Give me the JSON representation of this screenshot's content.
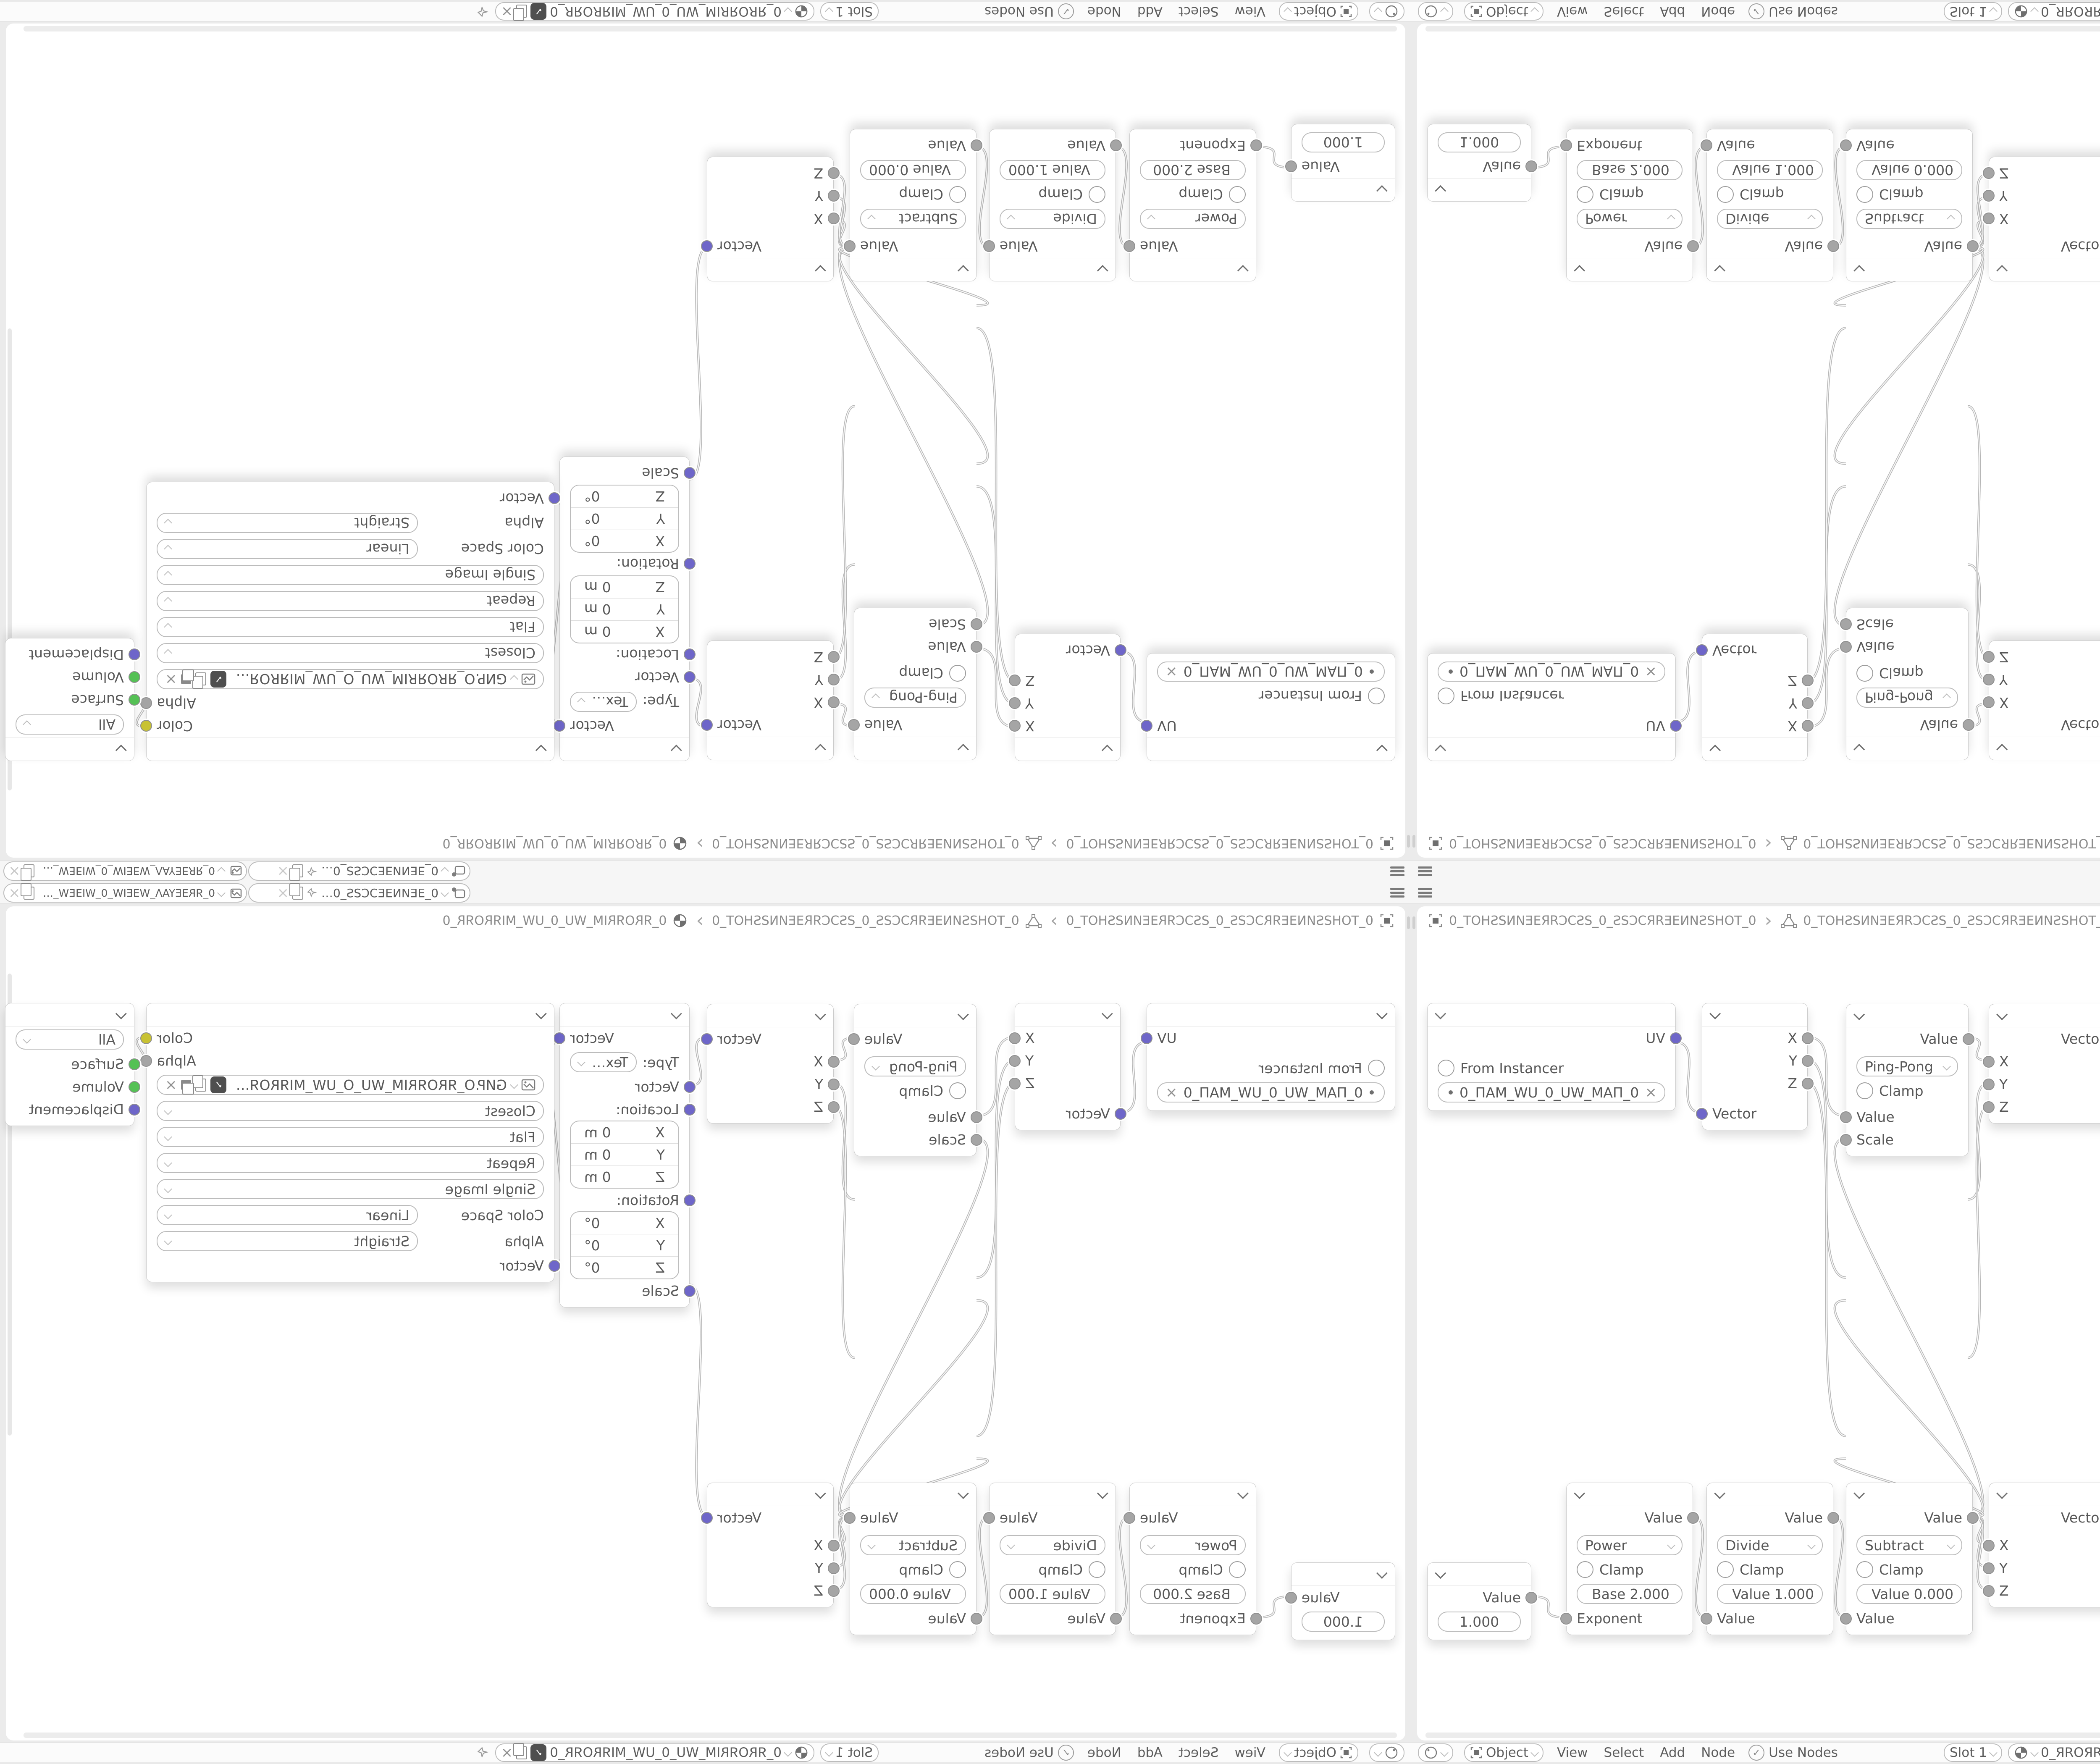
{
  "colors": {
    "socket_vector": "#6e66c9",
    "socket_value": "#a5a5a5",
    "socket_color": "#c8c233",
    "socket_shader": "#55c155",
    "wire": "#b6b6b6",
    "node_bg": "#ffffff",
    "editor_bg": "#ffffff",
    "chrome_bg": "#f6f6f6"
  },
  "topbar": {
    "scene_name": "0_ƎEИNƎEƆCƧS_0_ƧSƆCƎEИNƎE_0",
    "view_layer_name": "0_ЯRƎEYAΛ_WƎEIW_0_WIƎEW_ΛAYƎEЯR_0"
  },
  "breadcrumb": {
    "scene": "0_TOHƧSИNƎEЯRƆCƧS_0_ƧSƆCЯRƎEИNƧSHOT_0",
    "object": "0_TOHƧSИNƎEЯRƆCƧS_0_ƧSƆCЯRƎEИNƧSHOT_0",
    "material": "0_ЯROЯRIM_WU_0_UW_MIЯROЯR_0"
  },
  "statusbar": {
    "shader_type": "Object",
    "menus": [
      "View",
      "Select",
      "Add",
      "Node"
    ],
    "use_nodes": "Use Nodes",
    "slot": "Slot 1",
    "material_name": "0_ЯROЯRIM_WU_0_UW_MIЯROЯR_0"
  },
  "axes": [
    "X",
    "Y",
    "Z"
  ],
  "nodes": {
    "uv_map": {
      "output": "UV",
      "from_instancer": "From Instancer",
      "uv_name": "0_ПAM_WU_0_UW_MAП_0"
    },
    "separate_xyz": {
      "input": "Vector"
    },
    "ping_pong": {
      "output": "Value",
      "operation": "Ping-Pong",
      "clamp": "Clamp",
      "value_in": "Value",
      "scale_in": "Scale"
    },
    "combine_xyz": {
      "output": "Vector"
    },
    "mapping": {
      "output": "Vector",
      "type_label": "Type:",
      "type": "Texture",
      "vector_in": "Vector",
      "location_label": "Location:",
      "location": [
        "0 m",
        "0 m",
        "0 m"
      ],
      "rotation_label": "Rotation:",
      "rotation": [
        "0°",
        "0°",
        "0°"
      ],
      "scale_label": "Scale"
    },
    "image_texture": {
      "color_out": "Color",
      "alpha_out": "Alpha",
      "image_name": "GИP.O_ЯROЯRIM_WU_O_UW_MIЯROЯR_O.PNG",
      "interpolation": "Closest",
      "projection": "Flat",
      "extension": "Repeat",
      "source": "Single Image",
      "color_space_label": "Color Space",
      "color_space": "Linear",
      "alpha_label": "Alpha",
      "alpha_mode": "Straight",
      "vector_in": "Vector"
    },
    "material_output": {
      "target": "All",
      "surface": "Surface",
      "volume": "Volume",
      "displacement": "Displacement"
    },
    "value": {
      "output": "Value",
      "value": "1.000"
    },
    "power": {
      "output": "Value",
      "operation": "Power",
      "clamp": "Clamp",
      "field_label": "Base",
      "field_value": "2.000",
      "input": "Exponent"
    },
    "divide": {
      "output": "Value",
      "operation": "Divide",
      "clamp": "Clamp",
      "field_label": "Value",
      "field_value": "1.000",
      "input": "Value"
    },
    "subtract": {
      "output": "Value",
      "operation": "Subtract",
      "clamp": "Clamp",
      "field_label": "Value",
      "field_value": "0.000",
      "input": "Value"
    }
  },
  "glyphs": {
    "close": "×",
    "check": "✓",
    "crumb_sep": "›",
    "use_nodes_check": "✓"
  }
}
